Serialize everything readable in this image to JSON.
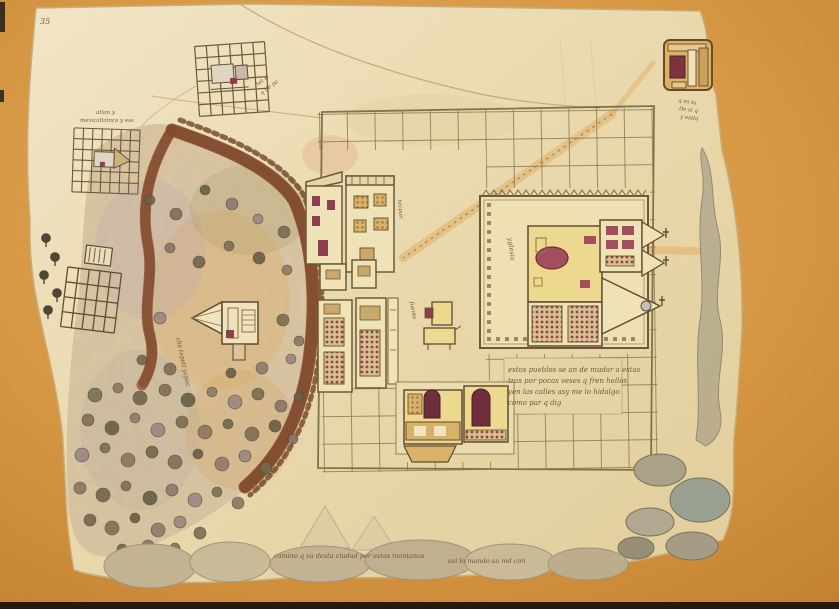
{
  "map_labels": {
    "corner_mark": "35",
    "north_town_label_1": "tet si",
    "north_town_label_2": "q tle pa",
    "west_town_label_1": "atlan y",
    "west_town_label_2": "mexicaltzinco y ess",
    "hill_label": "che tepetl ycpac",
    "church_label": "yglesia",
    "fountain_label": "fuente",
    "west_row_label": "tecpan",
    "northeast_label_1": "q es ta",
    "northeast_label_2": "tle si q",
    "northeast_label_3": "y estla",
    "note_lines": [
      "estos pueblos se an de mudar a estas",
      "tras por pocas veses q fren hellos",
      "yen las calles asy me lo hidalgo",
      "como par q dig"
    ],
    "bottom_caption_1": "camino q va desta ciudad por estas montanas",
    "bottom_caption_2": "asi lo mando su md con"
  },
  "palette": {
    "cork_background": "#dd9a44",
    "paper": "#ecdcb2",
    "grid_ink": "#8a7850",
    "wall_brown": "#9a5c3a",
    "door_maroon": "#8e3f4e",
    "building_yellow": "#ecd88e",
    "building_tan": "#d9b26a",
    "hill_wash": "#d7c29c",
    "bush_green": "#6d6148",
    "ink_text": "#5c452c"
  }
}
